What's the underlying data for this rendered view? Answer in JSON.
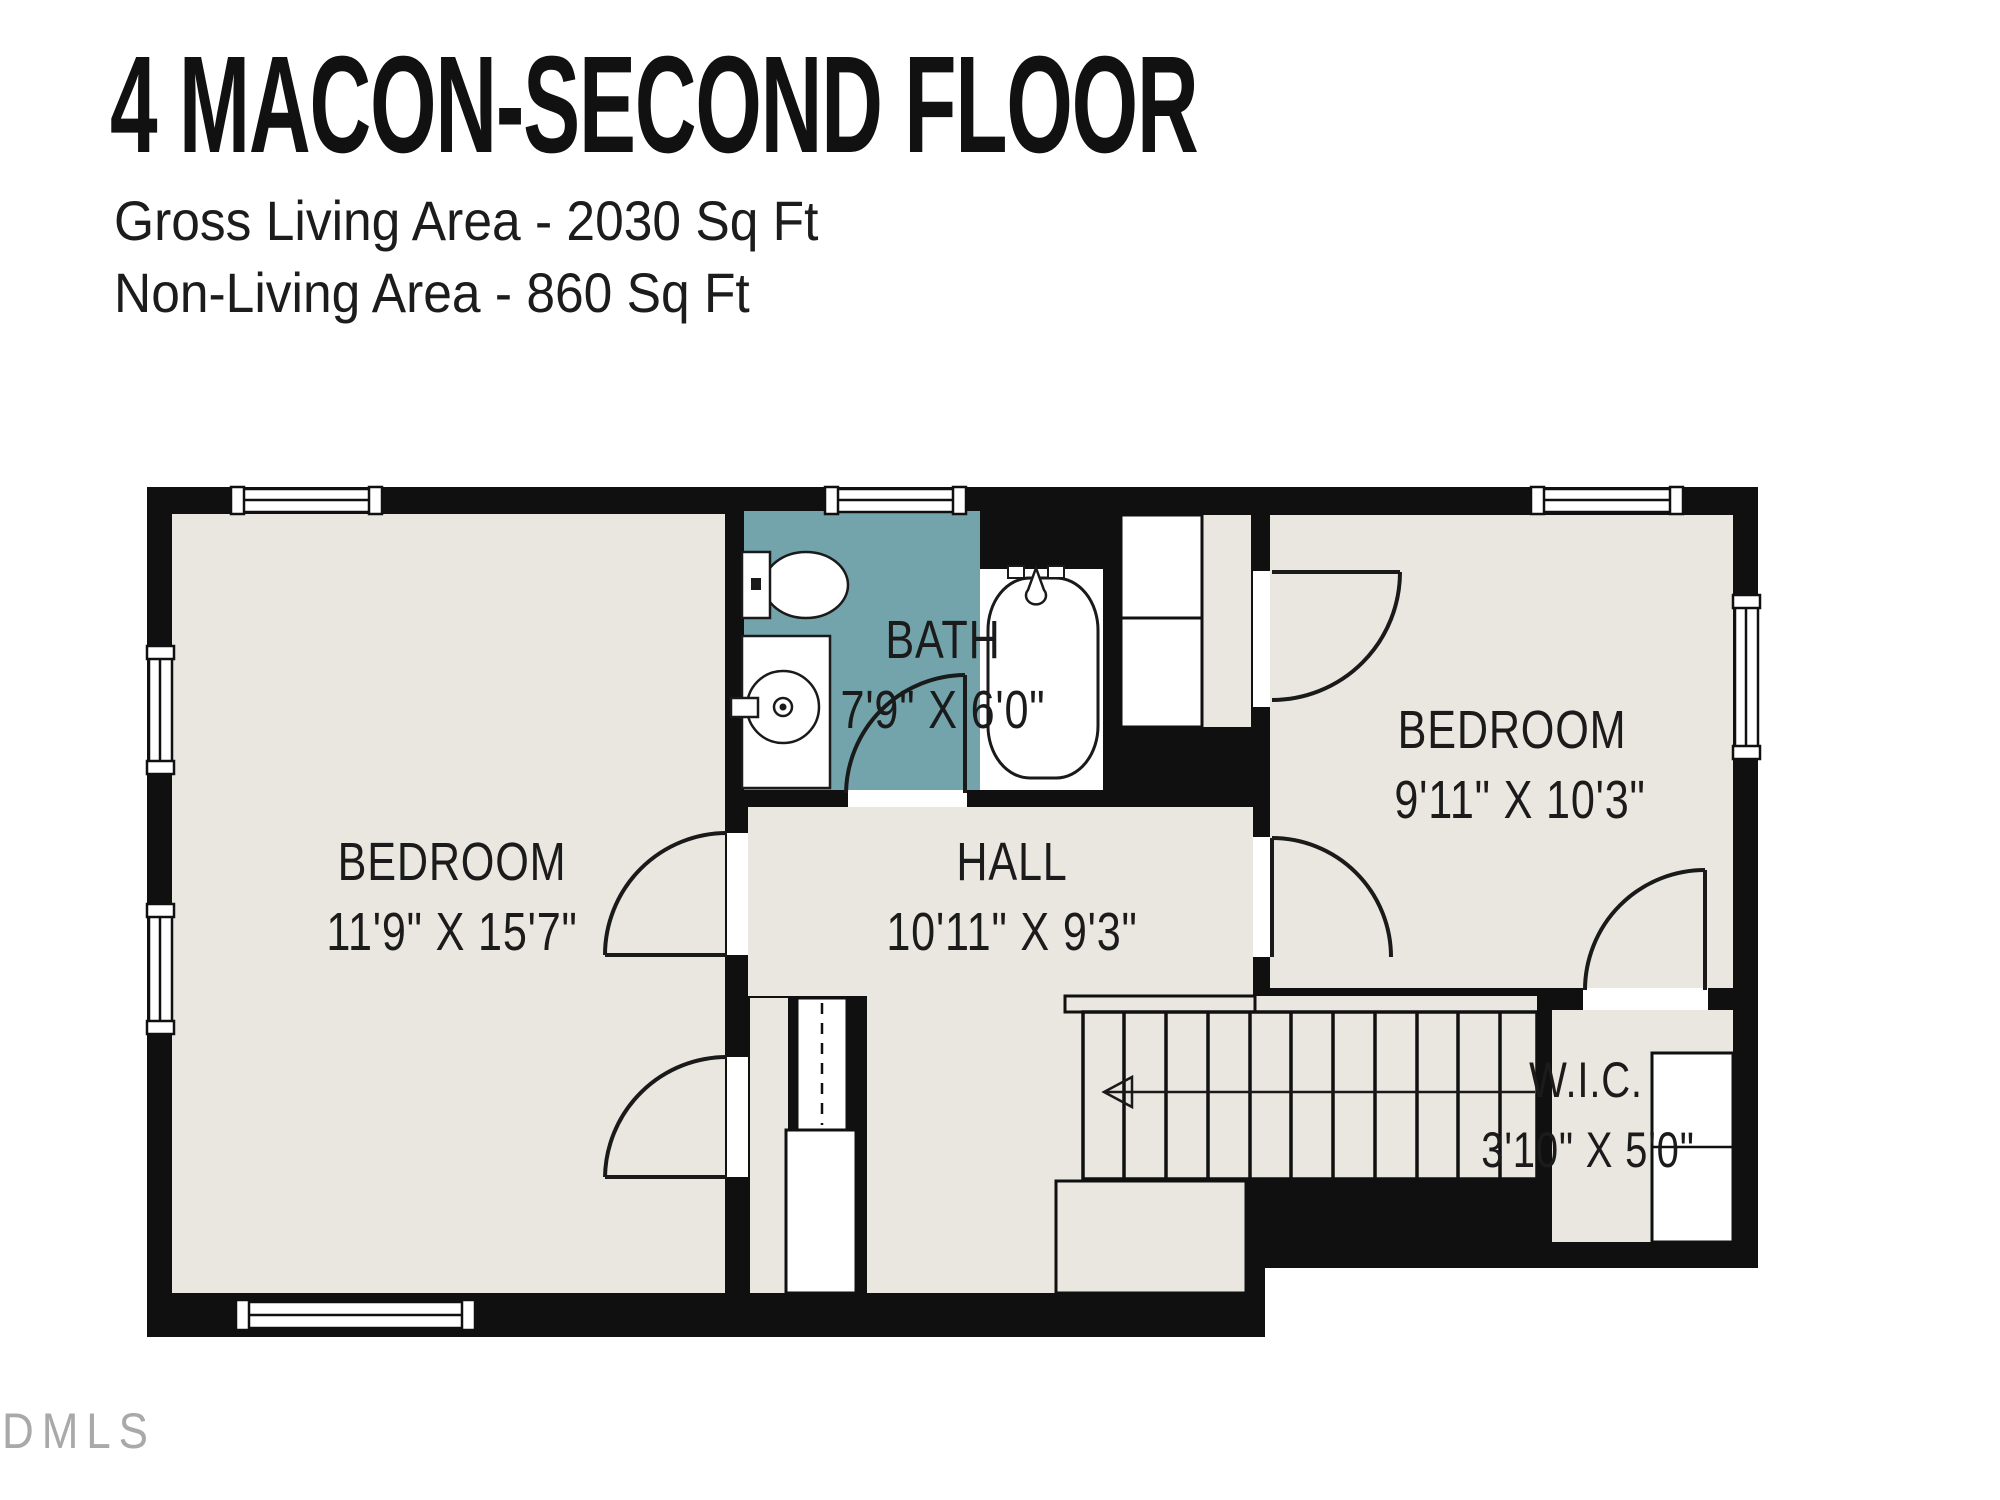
{
  "header": {
    "title": "4 MACON-SECOND FLOOR",
    "subtitle1": "Gross Living Area - 2030 Sq Ft",
    "subtitle2": "Non-Living Area - 860 Sq Ft"
  },
  "rooms": {
    "bedroom_left": {
      "name": "BEDROOM",
      "dims": "11'9\" X 15'7\""
    },
    "bath": {
      "name": "BATH",
      "dims": "7'9\" X 6'0\""
    },
    "hall": {
      "name": "HALL",
      "dims": "10'11\" X 9'3\""
    },
    "bedroom_right": {
      "name": "BEDROOM",
      "dims": "9'11\" X 10'3\""
    },
    "wic": {
      "name": "W.I.C.",
      "dims": "3'10\" X 5'0\""
    }
  },
  "watermark": "DMLS",
  "colors": {
    "wall": "#101010",
    "room_floor": "#e9e7e0",
    "bath_floor": "#73a4ac",
    "fixture_fill": "#ffffff",
    "label_text": "#1b1b1b",
    "watermark_text": "#a9a9a9"
  }
}
